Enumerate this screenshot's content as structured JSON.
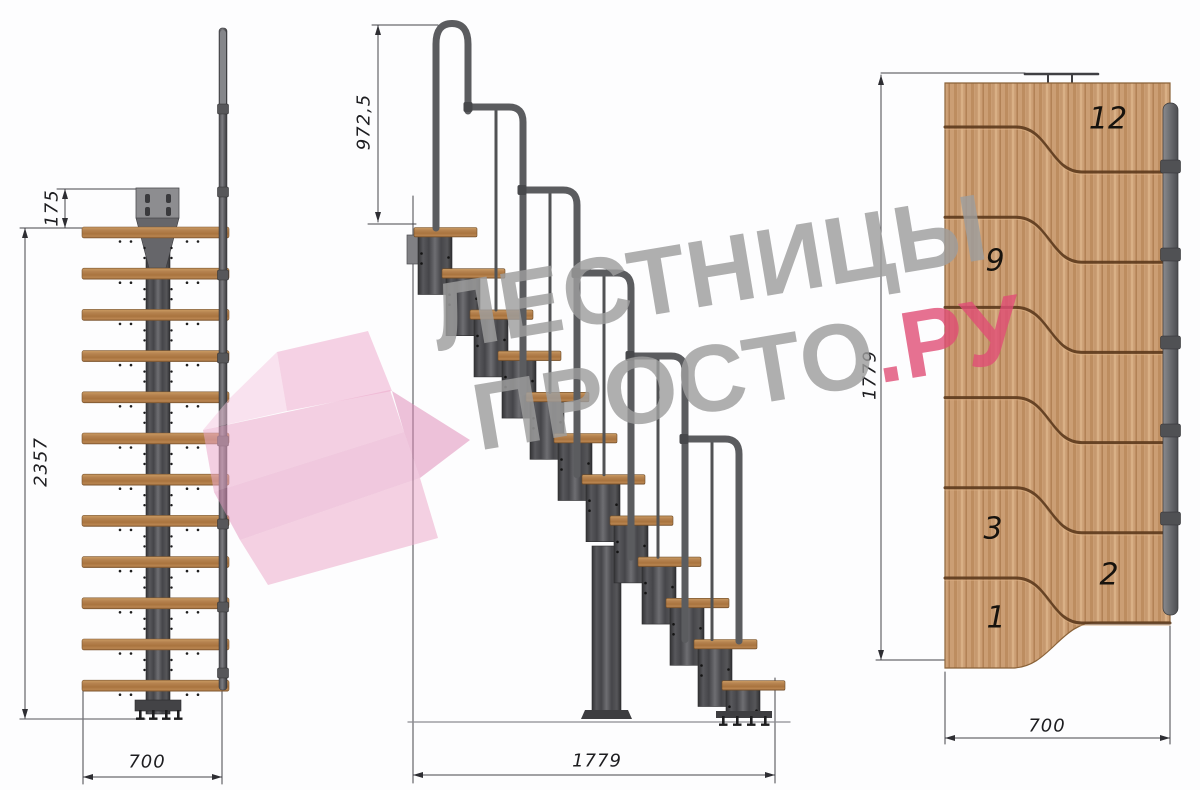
{
  "watermark": {
    "brand_line1": "ЛЕСТНИЦЫ",
    "brand_line2": "ПРОСТО",
    "brand_suffix": ".РУ",
    "accent_color": "#e04d76",
    "text_color": "#9e9e9e"
  },
  "front_view": {
    "dim_plate_offset": "175",
    "dim_height": "2357",
    "dim_width": "700"
  },
  "side_view": {
    "dim_rail_height": "972,5",
    "dim_length": "1779"
  },
  "top_view": {
    "dim_length": "1779",
    "dim_width": "700",
    "step_numbers": {
      "s12": "12",
      "s9": "9",
      "s3": "3",
      "s2": "2",
      "s1": "1"
    }
  },
  "colors": {
    "wood_top": "#cb9e74",
    "wood_side": "#b5824f",
    "metal_dark": "#46464a",
    "rail_gray": "#5b5c5f",
    "dim_line": "#44444a"
  }
}
